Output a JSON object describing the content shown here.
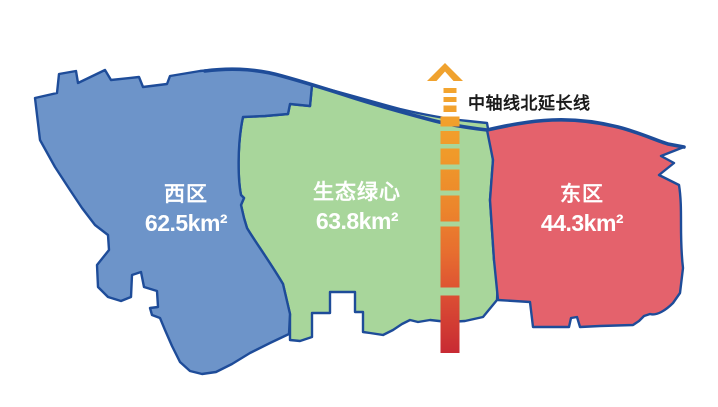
{
  "map": {
    "background": "#ffffff",
    "outline_color": "#1e4c99",
    "label_text_color": "#ffffff",
    "regions": [
      {
        "name": "西区",
        "area": "62.5km²",
        "fill": "#6d94c9"
      },
      {
        "name": "生态绿心",
        "area": "63.8km²",
        "fill": "#a8d69b"
      },
      {
        "name": "东区",
        "area": "44.3km²",
        "fill": "#e4626c"
      }
    ],
    "axis": {
      "label": "中轴线北延长线",
      "label_color": "#1a1a1a",
      "arrow_icon": "up-chevron-arrow",
      "color_top": "#f3a52f",
      "color_bottom": "#c82a33"
    }
  }
}
